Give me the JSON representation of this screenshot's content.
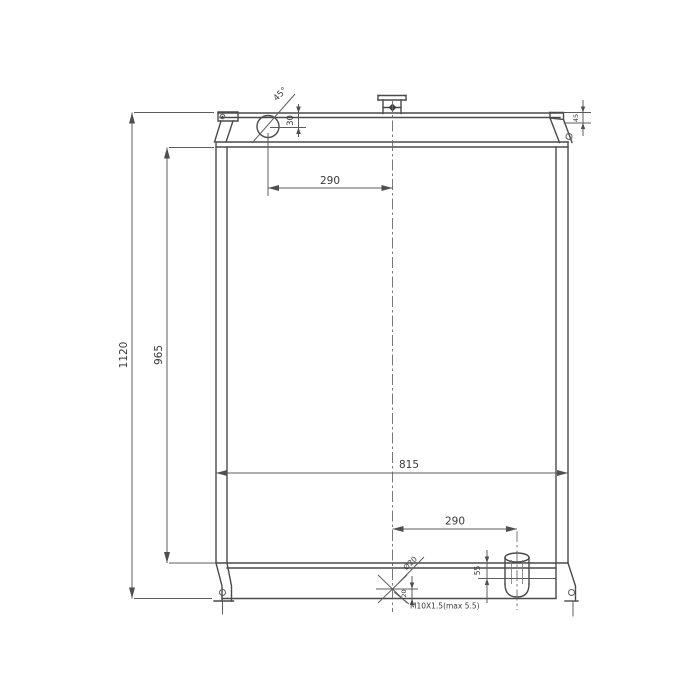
{
  "colors": {
    "background": "#ffffff",
    "line": "#4a4a4a",
    "dimension_line": "#5c5c5c",
    "text": "#3a3a3a"
  },
  "drawing": {
    "kind": "radiator engineering drawing, front view",
    "dims": {
      "overall_height": "1120",
      "core_height": "965",
      "core_width": "815",
      "filler_offset_horizontal": "290",
      "filler_offset_vertical": "30",
      "filler_chamfer_angle": "45°",
      "bracket_hole_offset": "45",
      "outlet_offset_horizontal": "290",
      "outlet_height": "55",
      "drain_hole_diameter": "Ø20",
      "drain_offset_vertical": "20",
      "drain_thread_note": "M10X1.5(max 5.5)"
    }
  }
}
